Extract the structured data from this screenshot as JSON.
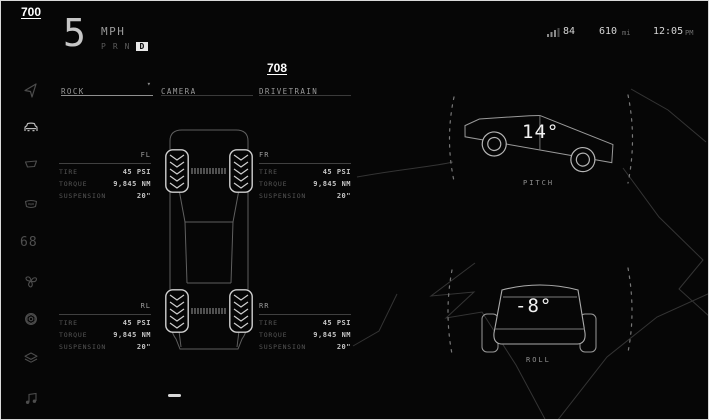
{
  "annotations": {
    "screen_label": "700",
    "drivetrain_label": "708"
  },
  "cluster": {
    "speed": "5",
    "speed_unit": "MPH",
    "gear_p": "P",
    "gear_r": "R",
    "gear_n": "N",
    "gear_d": "D",
    "active_gear": "D"
  },
  "status": {
    "temperature": "84",
    "range": "610",
    "range_unit": "mi",
    "time": "12:05",
    "meridiem": "PM"
  },
  "sidebar": {
    "temperature": "68",
    "items": [
      "navigation",
      "vehicle",
      "wiper",
      "defrost",
      "temperature",
      "fan",
      "wheel-hub",
      "layers",
      "media"
    ]
  },
  "tabs": {
    "rock": "ROCK",
    "camera": "CAMERA",
    "drivetrain": "DRIVETRAIN",
    "dropdown_caret": "▾",
    "active": "ROCK"
  },
  "drivetrain_panel": {
    "row_labels": {
      "tire": "TIRE",
      "torque": "TORQUE",
      "suspension": "SUSPENSION"
    },
    "corners": [
      {
        "id": "FL",
        "tire": "45 PSI",
        "torque": "9,845 NM",
        "suspension": "20\""
      },
      {
        "id": "FR",
        "tire": "45 PSI",
        "torque": "9,845 NM",
        "suspension": "20\""
      },
      {
        "id": "RL",
        "tire": "45 PSI",
        "torque": "9,845 NM",
        "suspension": "20\""
      },
      {
        "id": "RR",
        "tire": "45 PSI",
        "torque": "9,845 NM",
        "suspension": "20\""
      }
    ]
  },
  "attitude": {
    "pitch_value": "14°",
    "pitch_label": "PITCH",
    "roll_value": "-8°",
    "roll_label": "ROLL"
  },
  "colors": {
    "background": "#060606",
    "bright": "#e8e8e8",
    "dim": "#5a5a5a",
    "divider": "#404040",
    "wireframe": "#8c8c8c",
    "terrain": "#343434"
  }
}
